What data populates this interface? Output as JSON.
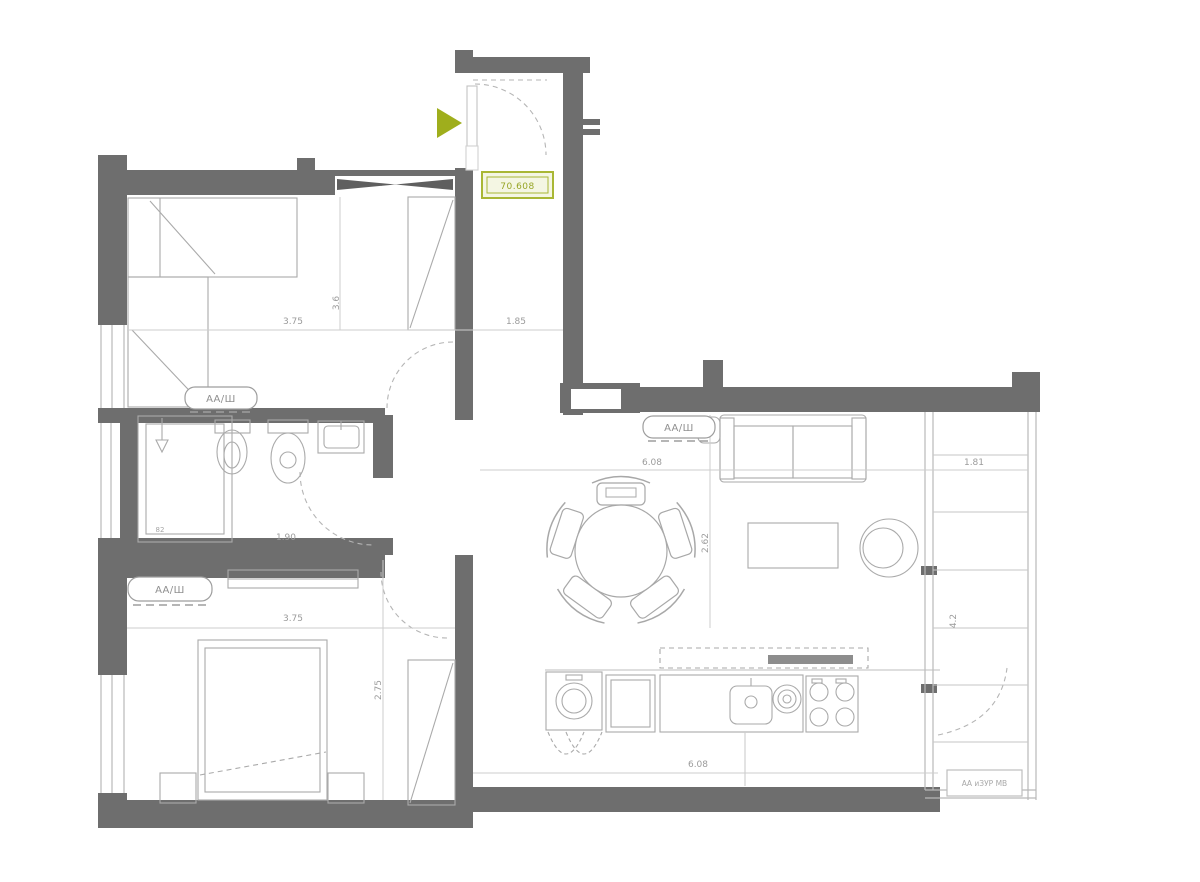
{
  "plan": {
    "entry_area_label": "70.608",
    "window_label_bedroom1": "АА/Ш",
    "window_label_living": "АА/Ш",
    "window_label_bedroom2": "АА/Ш",
    "balcony_tag": "АА иЗУР МВ",
    "dims": {
      "bedroom1_width": "3.75",
      "bedroom1_height": "3.6",
      "corridor_width": "1.85",
      "living_width": "6.08",
      "living_height": "2.62",
      "balcony_width": "1.81",
      "balcony_height": "4.2",
      "bedroom2_width": "3.75",
      "bedroom2_height": "2.75",
      "kitchen_width": "6.08",
      "bathroom_width": "1.90",
      "shower_depth": "82"
    },
    "colors": {
      "wall": "#6e6e6e",
      "accent_green": "#9fae1c",
      "furniture_line": "#a8a8a8",
      "dim_text": "#9b9b9b"
    }
  }
}
